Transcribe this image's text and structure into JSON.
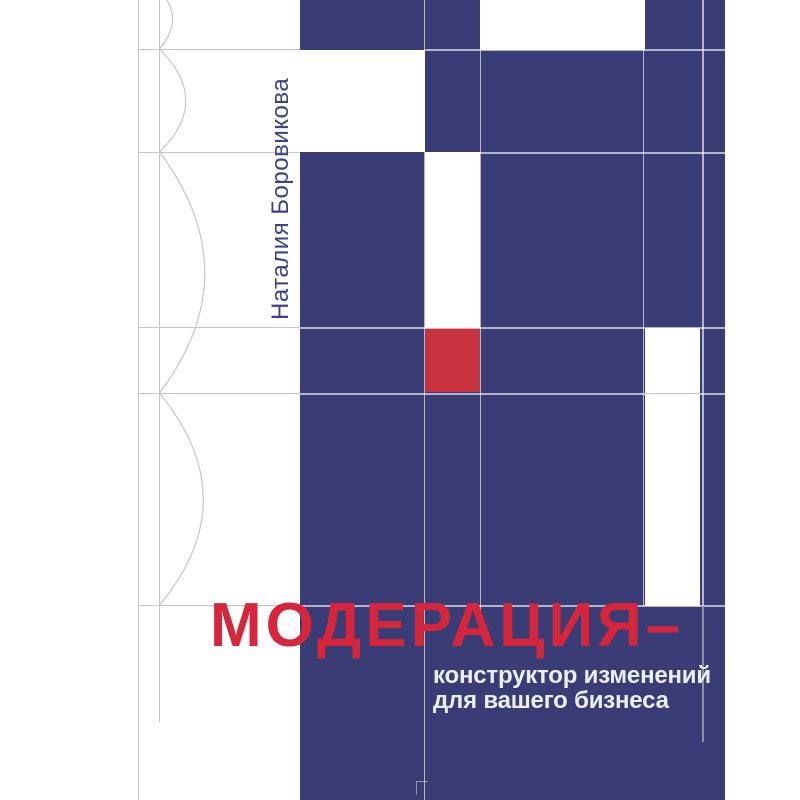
{
  "cover": {
    "author": "Наталия Боровикова",
    "title": "МОДЕРАЦИЯ–",
    "subtitle": {
      "line1": "конструктор изменений",
      "line2": "для вашего бизнеса"
    },
    "colors": {
      "navy": "#3A3D75",
      "red_square": "#C8333F",
      "title_red": "#D5263C",
      "subtitle_white": "#EDEFF7",
      "author_blue": "#3E4386",
      "line_gray": "#C3C6CC",
      "line_light": "rgba(255,255,255,0.62)",
      "line_dark": "#8A8FA4",
      "background": "#FFFFFF"
    }
  }
}
